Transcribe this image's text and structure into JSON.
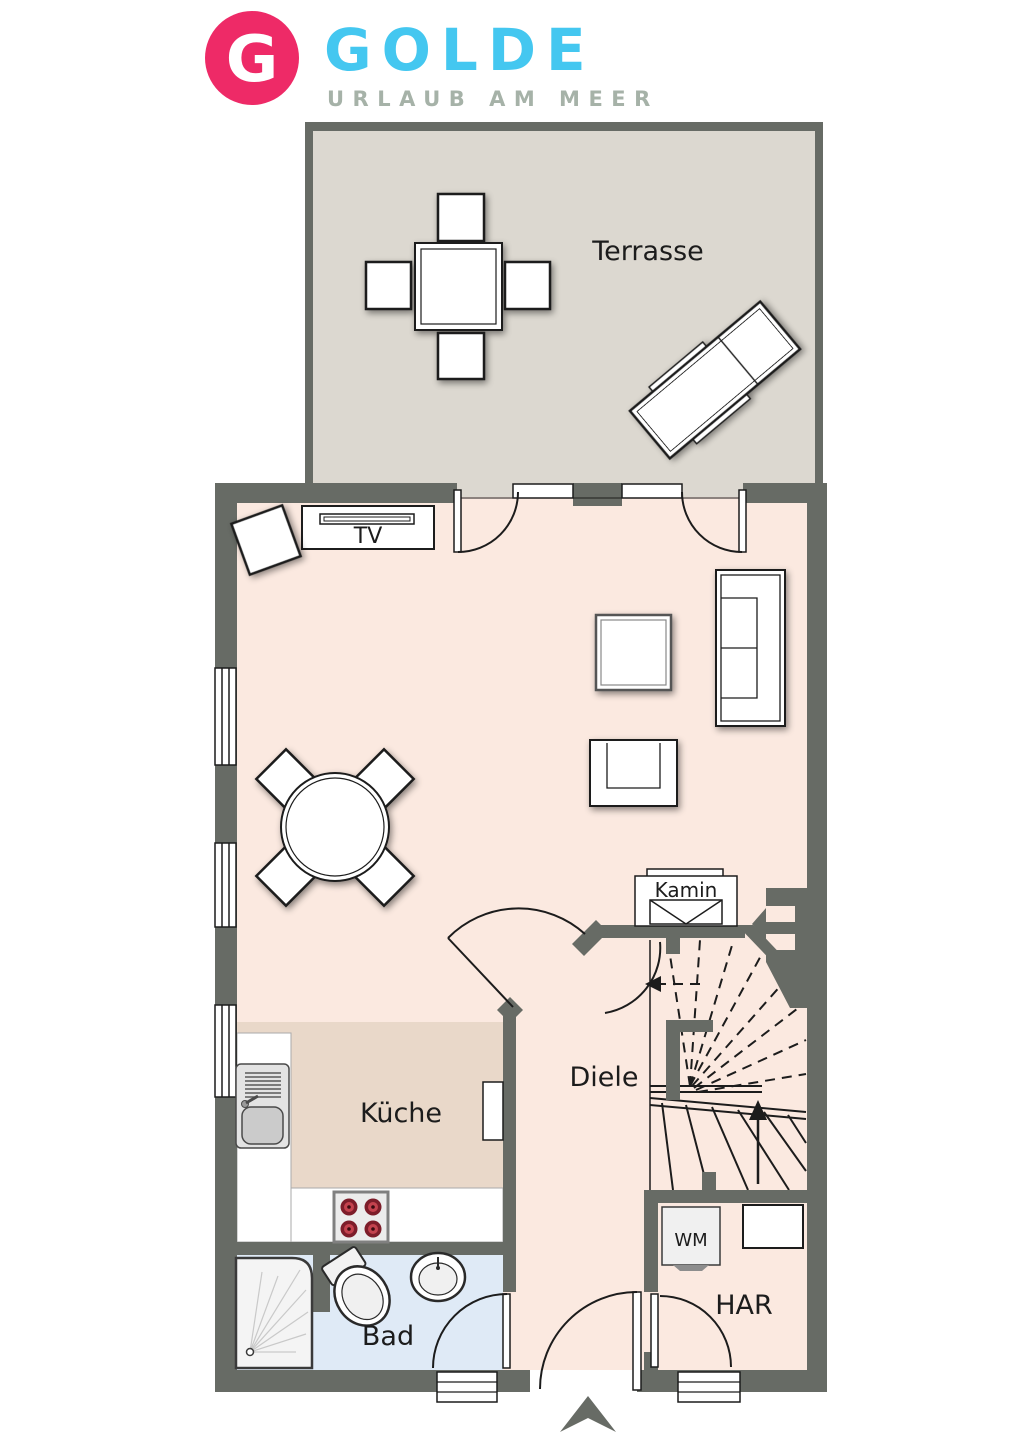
{
  "logo": {
    "monogram": "G",
    "brand": "GOLDE",
    "tagline": "URLAUB AM MEER"
  },
  "rooms": {
    "terrace": "Terrasse",
    "kitchen": "Küche",
    "hall": "Diele",
    "bath": "Bad",
    "utility": "HAR"
  },
  "features": {
    "tv": "TV",
    "fireplace": "Kamin",
    "washing_machine": "WM"
  },
  "icons": {
    "entry_arrow": "entry-direction-arrow",
    "stair_up_arrow": "stairs-up-arrow"
  },
  "colors": {
    "logo_pink": "#ee2a67",
    "logo_cyan": "#44c7f0",
    "logo_tagline_gray": "#a6b2a8",
    "wall_gray": "#676b65",
    "living_floor_pink": "#fbe9e0",
    "kitchen_floor_tan": "#e9d8c9",
    "terrace_floor_greige": "#dcd8d0",
    "bath_floor_blue": "#dfeaf6",
    "stove_burner_red": "#7d1d2a",
    "line_black": "#1c1c1c"
  }
}
